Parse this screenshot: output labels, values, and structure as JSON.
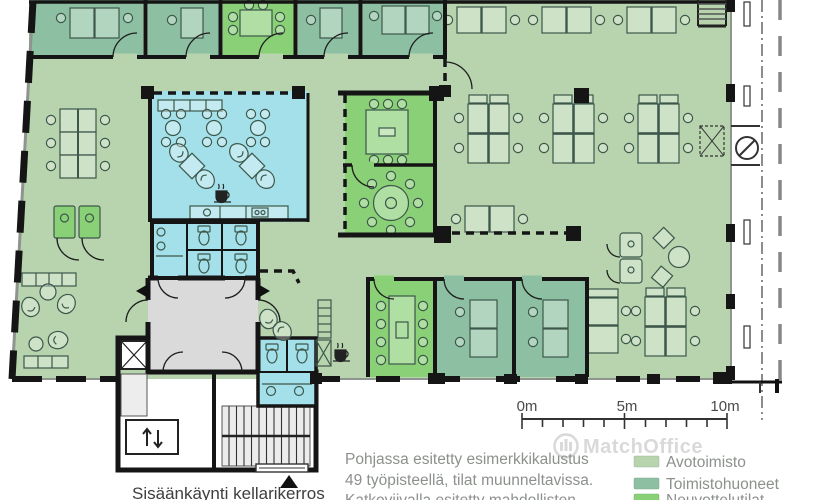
{
  "floorplan": {
    "watermark_text": "MatchOffice",
    "entrance_label": "Sisäänkäynti kellarikerros",
    "caption_lines": {
      "line1": "Pohjassa esitetty esimerkkikalustus",
      "line2": "49 työpisteellä, tilat muunneltavissa.",
      "line3": "Katkoviivalla esitetty mahdollisten"
    },
    "scale_bar": {
      "start_label": "0m",
      "mid_label": "5m",
      "end_label": "10m"
    },
    "legend": {
      "items": [
        {
          "label": "Avotoimisto",
          "color": "#b7d4ae"
        },
        {
          "label": "Toimistohuoneet",
          "color": "#8dc0a2"
        },
        {
          "label": "Neuvottelutilat",
          "color": "#8ad077"
        }
      ]
    },
    "colors": {
      "open_office": "#b7d4ae",
      "office_room": "#8dc0a2",
      "meeting_room": "#8ad077",
      "wet_area": "#a4e0e9",
      "lobby": "#dadada",
      "wall": "#151515"
    }
  }
}
